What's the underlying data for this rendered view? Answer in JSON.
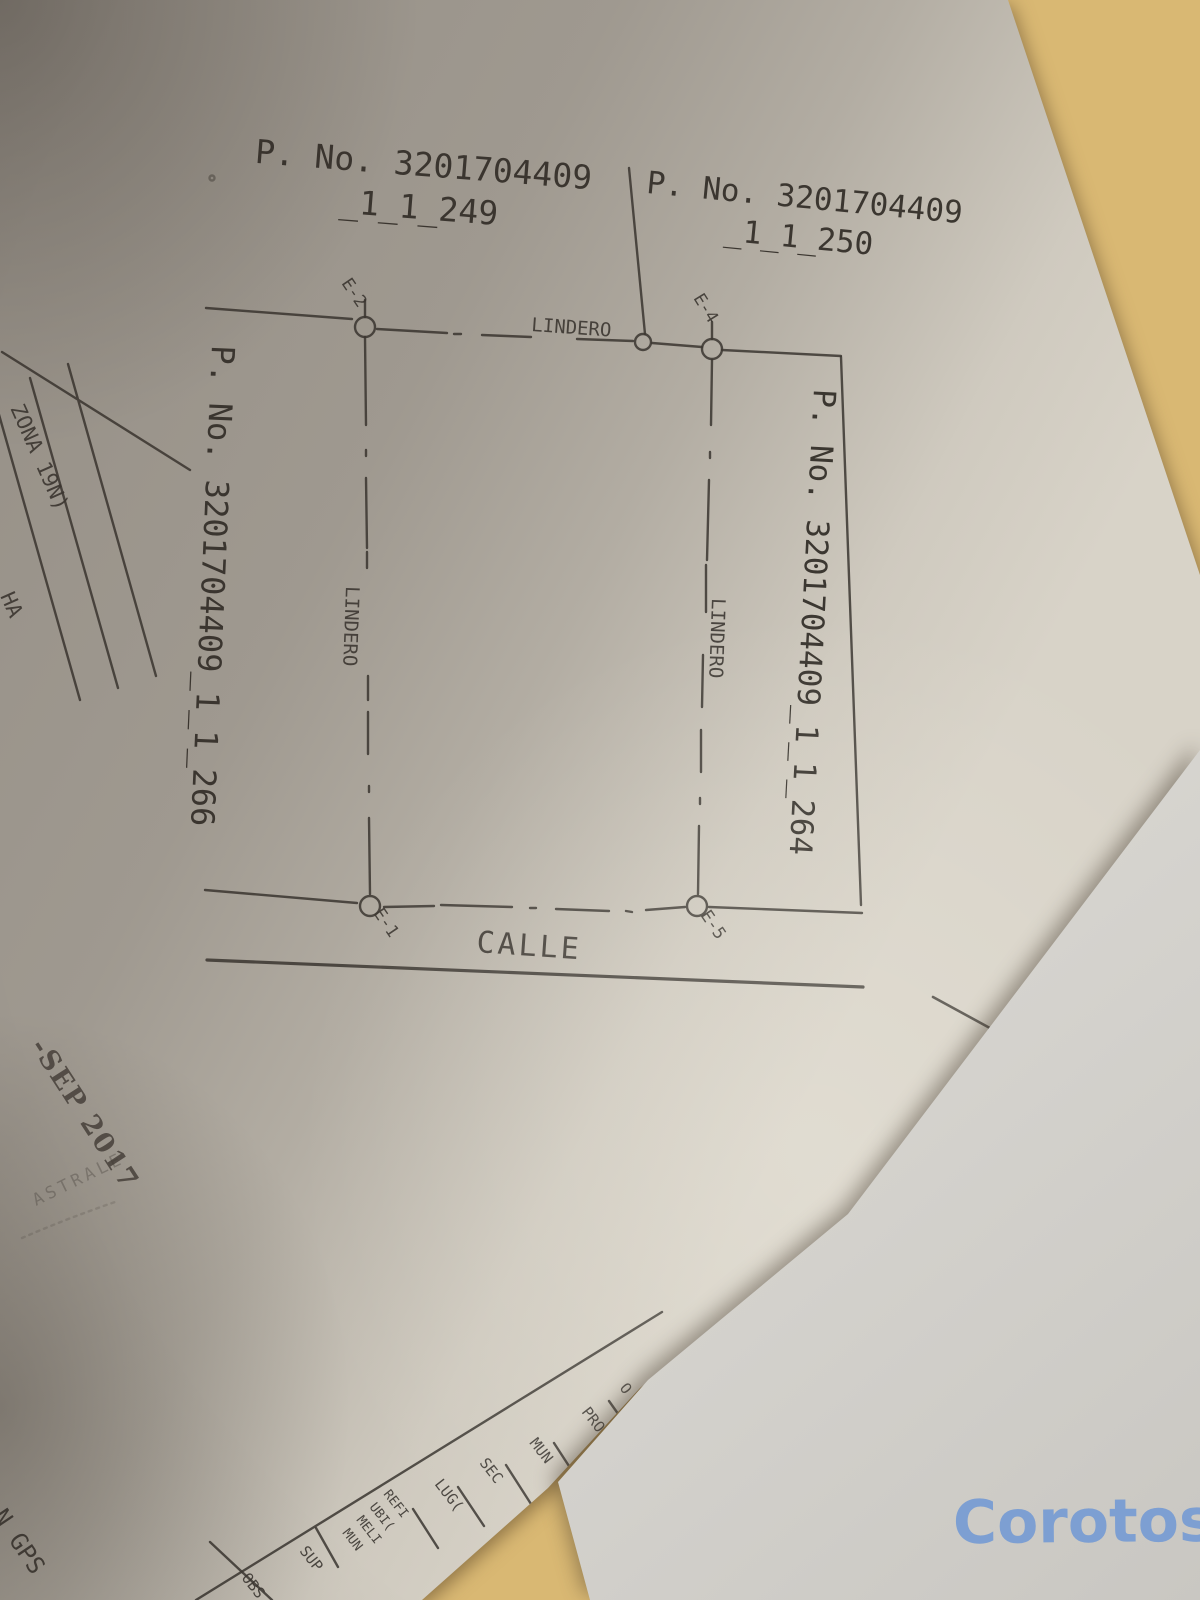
{
  "photo": {
    "watermark": "Corotos",
    "watermark_color": "#7d9fd2",
    "ink_color": "#3e3a34"
  },
  "plan": {
    "parcels": {
      "top_left_line1": "P. No. 3201704409",
      "top_left_line2": "_1_1_249",
      "top_right_line1": "P. No. 3201704409",
      "top_right_line2": "_1_1_250",
      "left_vertical": "P. No. 3201704409_1_1_266",
      "center_vertical": "P. No. 3201704409_1_1_264"
    },
    "boundaries": {
      "top": "LINDERO",
      "left": "LINDERO",
      "right": "LINDERO"
    },
    "street": "CALLE",
    "stations": {
      "top_left": "E-2",
      "top_right": "E-4",
      "bottom_left": "E-1",
      "bottom_right": "E-5"
    },
    "margin_table": {
      "row1": "ZONA 19N)",
      "row2": "HA"
    },
    "stamps": {
      "date": "-SEP 2017",
      "seal_fragment": "ASTRALE",
      "note_fragment": "N GPS"
    },
    "footer_table": {
      "labels": [
        "OBS",
        "SUP",
        "MUN",
        "MELI",
        "UBI(",
        "REFI",
        "LUG(",
        "SEC",
        "MUN",
        "PRO'",
        "O"
      ]
    }
  }
}
